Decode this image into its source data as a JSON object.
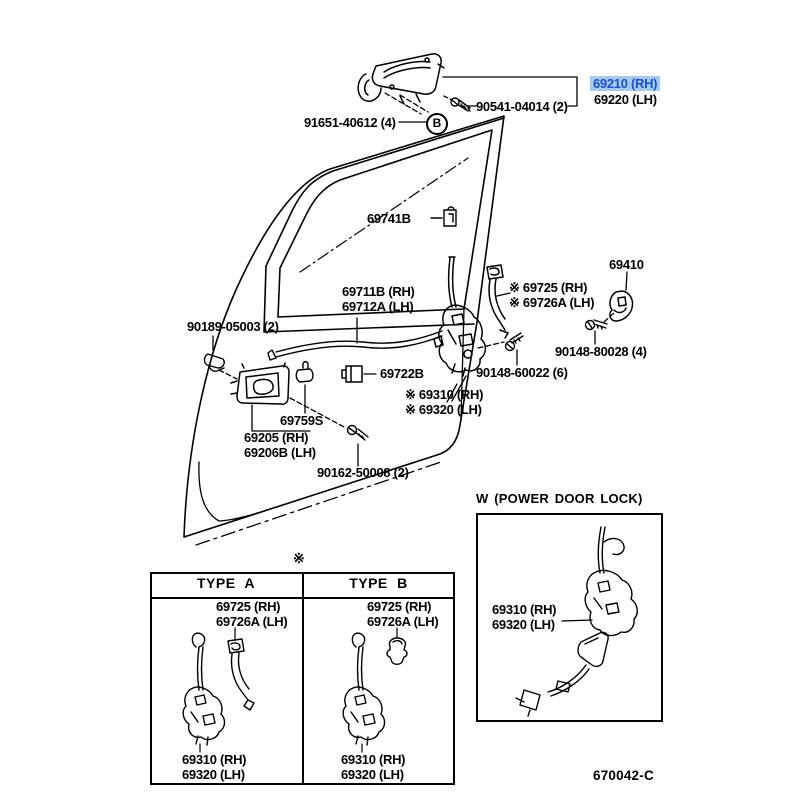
{
  "doc": {
    "number": "670042-C"
  },
  "colors": {
    "highlight_bg": "#a6c9ee",
    "highlight_text": "#1c50c5",
    "line": "#000000",
    "background": "#ffffff"
  },
  "callouts": {
    "handle_rh": "69210 (RH)",
    "handle_lh": "69220 (LH)",
    "screw_90541": "90541-04014 (2)",
    "screw_91651": "91651-40612 (4)",
    "callout_b": "B",
    "clip_69741b": "69741B",
    "link_69711b": "69711B (RH)\n69712A (LH)",
    "clip_90189": "90189-05003 (2)",
    "guide_69725": "※ 69725   (RH)\n※ 69726A (LH)",
    "striker_69410": "69410",
    "screw_90148_80028": "90148-80028 (4)",
    "screw_90148_60022": "90148-60022 (6)",
    "clip_69722b": "69722B",
    "lock_69310": "※ 69310 (RH)\n※ 69320 (LH)",
    "rod_69759s": "69759S",
    "inside_handle_69205": "69205   (RH)\n69206B (LH)",
    "screw_90162": "90162-50008 (2)",
    "table_star": "※"
  },
  "table": {
    "type_a": {
      "header": "TYPE A",
      "guide": "69725   (RH)\n69726A (LH)",
      "lock": "69310 (RH)\n69320 (LH)"
    },
    "type_b": {
      "header": "TYPE B",
      "guide": "69725   (RH)\n69726A (LH)",
      "lock": "69310 (RH)\n69320 (LH)"
    }
  },
  "power_box": {
    "title": "W (POWER DOOR LOCK)",
    "lock": "69310 (RH)\n69320 (LH)"
  }
}
